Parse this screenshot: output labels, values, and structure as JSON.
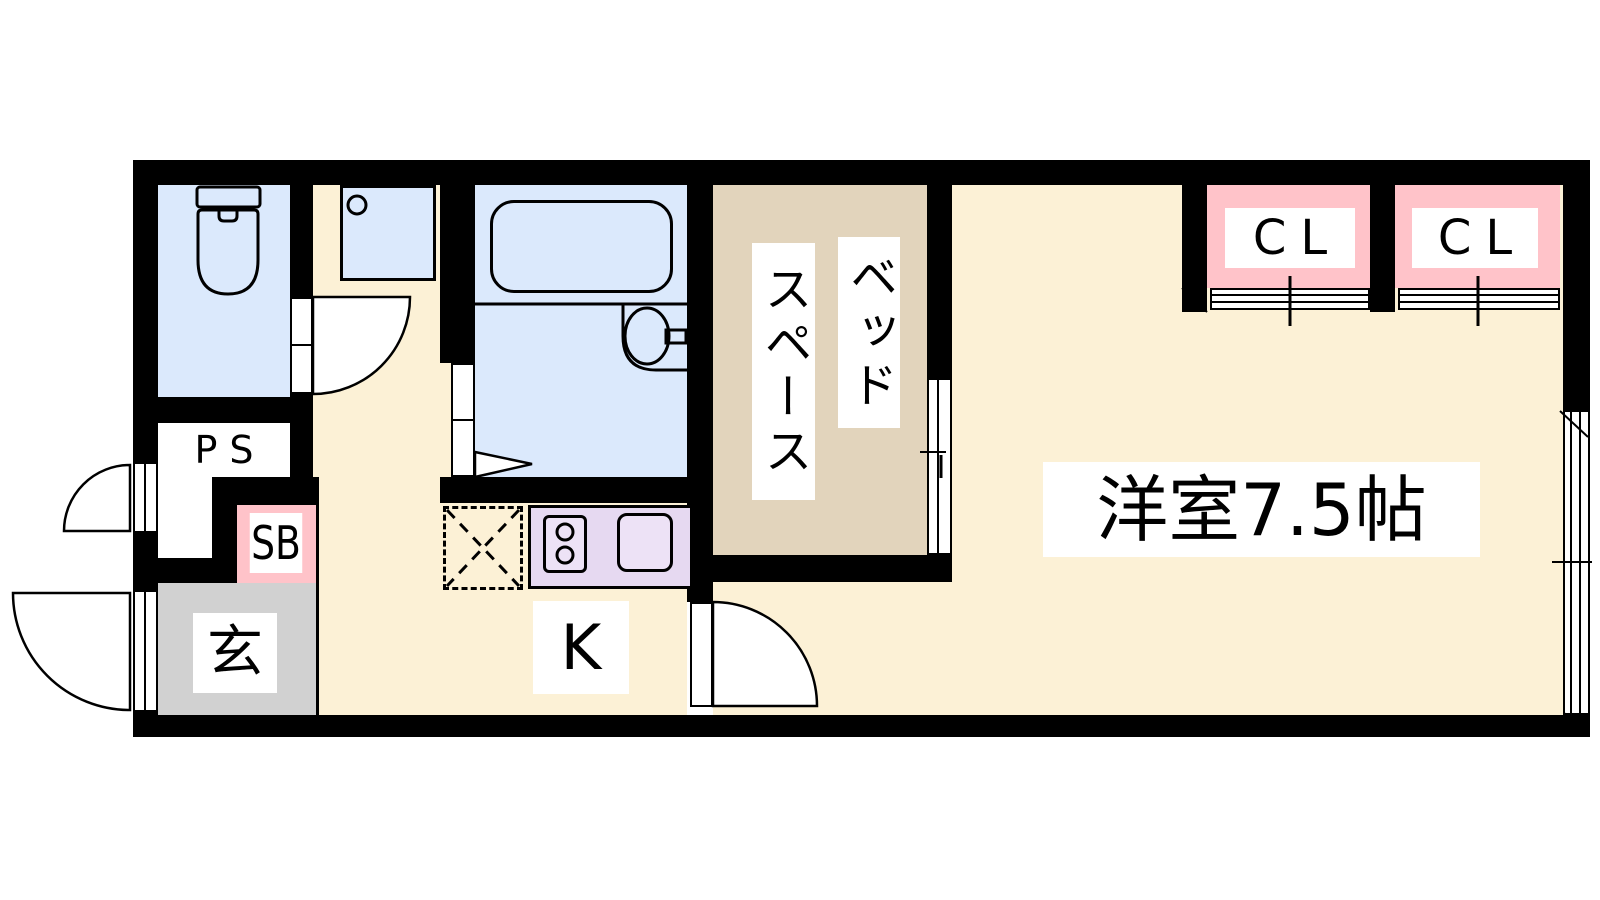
{
  "plan_title": "1K apartment floor plan",
  "rooms": {
    "western_room": "洋室7.5帖",
    "bed_space_col1": "ベッド",
    "bed_space_col2": "スペース",
    "kitchen": "K",
    "entrance": "玄",
    "closet_left": "CL",
    "closet_right": "CL",
    "pipe_space": "PS",
    "shoe_box": "SB"
  },
  "colors": {
    "wall": "#000000",
    "floor_cream": "#FCF1D6",
    "bed_space_tan": "#E2D4BC",
    "water_area_blue": "#DBE9FC",
    "kitchen_counter_purple": "#E6D9F1",
    "closet_pink": "#FFC3C9",
    "entrance_gray": "#D1D1D1",
    "label_background": "#FFFFFF"
  }
}
